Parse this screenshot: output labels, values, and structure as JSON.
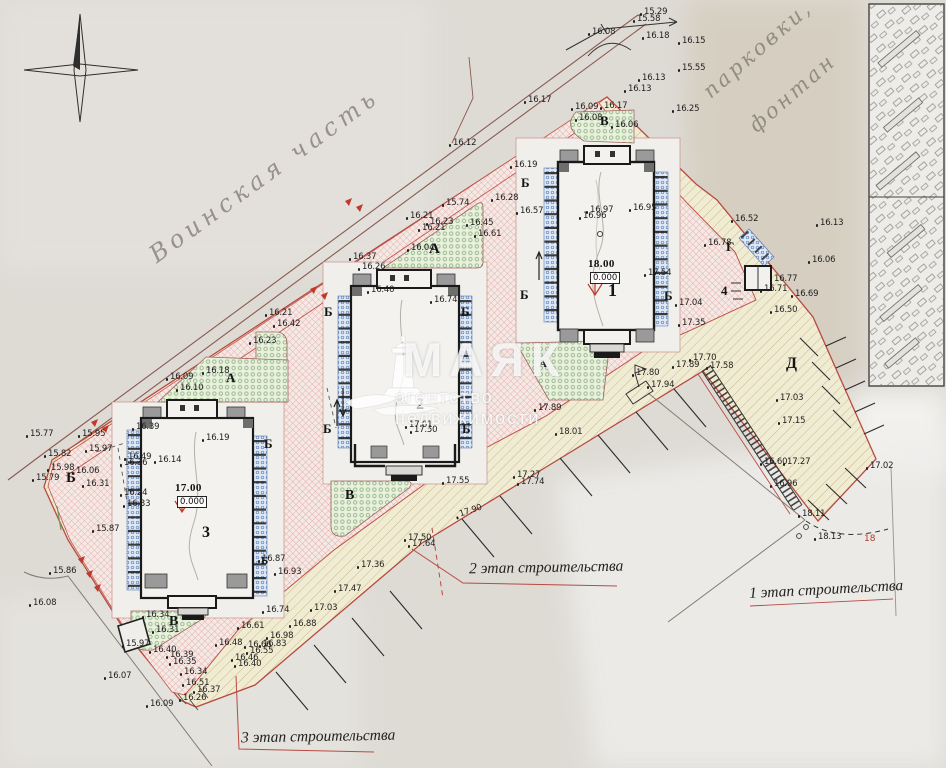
{
  "watermark": {
    "brand": "МАЯК",
    "tagline": "агентство недвижимости"
  },
  "handwriting": {
    "military_area": "Воинская часть",
    "parking": "парковки,",
    "fountain": "фонтан"
  },
  "stages": [
    {
      "label": "1 этап строительства"
    },
    {
      "label": "2 этап строительства"
    },
    {
      "label": "3 этап строительства"
    }
  ],
  "buildings": [
    {
      "number": "1",
      "elevation": "18.00",
      "datum": "0.000"
    },
    {
      "number": "2",
      "marks": [
        "17.01",
        "17.50"
      ]
    },
    {
      "number": "3",
      "elevation": "17.00",
      "datum": "0.000"
    },
    {
      "number": "4"
    }
  ],
  "parking_count": "18",
  "building_labels": [
    {
      "t": "18.00",
      "x": 588,
      "y": 258,
      "s": 11,
      "cls": "blev",
      "name": "building-1-elevation"
    },
    {
      "t": "0.000",
      "x": 590,
      "y": 272,
      "s": 8.5,
      "cls": "bdat",
      "name": "building-1-datum"
    },
    {
      "t": "1",
      "x": 608,
      "y": 281,
      "s": 18,
      "cls": "bnum",
      "name": "building-1-number"
    },
    {
      "t": "2",
      "x": 416,
      "y": 397,
      "s": 16,
      "cls": "bnum",
      "name": "building-2-number"
    },
    {
      "t": "17.00",
      "x": 175,
      "y": 482,
      "s": 11,
      "cls": "blev",
      "name": "building-3-elevation"
    },
    {
      "t": "0.000",
      "x": 177,
      "y": 496,
      "s": 8.5,
      "cls": "bdat",
      "name": "building-3-datum"
    },
    {
      "t": "3",
      "x": 202,
      "y": 525,
      "s": 16,
      "cls": "bnum",
      "name": "building-3-number"
    },
    {
      "t": "4",
      "x": 721,
      "y": 284,
      "s": 13,
      "cls": "bnum",
      "name": "building-4-number"
    },
    {
      "t": "18",
      "x": 864,
      "y": 534,
      "s": 9,
      "cls": "rednum",
      "name": "parking-count"
    }
  ],
  "zone_letters": [
    [
      "В",
      600,
      114,
      13
    ],
    [
      "Б",
      521,
      176,
      13
    ],
    [
      "Б",
      520,
      288,
      13
    ],
    [
      "Б",
      664,
      289,
      13
    ],
    [
      "Г",
      726,
      240,
      13
    ],
    [
      "Д",
      786,
      356,
      16
    ],
    [
      "А",
      429,
      242,
      15
    ],
    [
      "Б",
      324,
      305,
      13
    ],
    [
      "Б",
      461,
      305,
      13
    ],
    [
      "Б",
      323,
      422,
      13
    ],
    [
      "Б",
      462,
      422,
      13
    ],
    [
      "В",
      345,
      489,
      14
    ],
    [
      "А",
      226,
      371,
      13
    ],
    [
      "Б",
      264,
      437,
      13
    ],
    [
      "Б",
      66,
      471,
      15
    ],
    [
      "Б",
      261,
      556,
      11
    ],
    [
      "В",
      169,
      615,
      14
    ],
    [
      "А",
      539,
      359,
      11
    ]
  ],
  "spot_elevations": [
    [
      "15.29",
      644,
      7
    ],
    [
      "15.58",
      637,
      14
    ],
    [
      "16.08",
      592,
      27
    ],
    [
      "16.18",
      646,
      31
    ],
    [
      "16.15",
      682,
      36
    ],
    [
      "15.55",
      682,
      63
    ],
    [
      "16.13",
      642,
      73
    ],
    [
      "16.13",
      628,
      84
    ],
    [
      "16.25",
      676,
      104
    ],
    [
      "16.09",
      575,
      102
    ],
    [
      "16.17",
      604,
      101
    ],
    [
      "16.08",
      579,
      113
    ],
    [
      "16.06",
      615,
      120
    ],
    [
      "16.17",
      528,
      95
    ],
    [
      "16.12",
      453,
      138
    ],
    [
      "16.19",
      514,
      160
    ],
    [
      "16.28",
      495,
      193
    ],
    [
      "16.57",
      520,
      206
    ],
    [
      "16.97",
      590,
      205
    ],
    [
      "16.96",
      583,
      211
    ],
    [
      "16.95",
      633,
      203
    ],
    [
      "17.54",
      648,
      268
    ],
    [
      "17.04",
      679,
      298
    ],
    [
      "17.35",
      682,
      318
    ],
    [
      "16.52",
      735,
      214
    ],
    [
      "16.78",
      708,
      238
    ],
    [
      "16.77",
      774,
      274
    ],
    [
      "16.71",
      764,
      284
    ],
    [
      "16.69",
      795,
      289
    ],
    [
      "16.50",
      774,
      305
    ],
    [
      "16.13",
      820,
      218
    ],
    [
      "16.06",
      812,
      255
    ],
    [
      "17.70",
      693,
      353
    ],
    [
      "17.89",
      676,
      360
    ],
    [
      "17.58",
      710,
      361
    ],
    [
      "17.80",
      636,
      368
    ],
    [
      "17.94",
      651,
      380
    ],
    [
      "17.03",
      780,
      393
    ],
    [
      "17.15",
      782,
      416
    ],
    [
      "16.60",
      764,
      457
    ],
    [
      "17.27",
      787,
      457
    ],
    [
      "16.96",
      774,
      479
    ],
    [
      "17.02",
      870,
      461
    ],
    [
      "18.11",
      802,
      509
    ],
    [
      "18.13",
      818,
      532
    ],
    [
      "18.01",
      559,
      427
    ],
    [
      "17.89",
      538,
      403
    ],
    [
      "15.74",
      446,
      198
    ],
    [
      "16.21",
      410,
      211
    ],
    [
      "16.23",
      430,
      217
    ],
    [
      "16.21",
      422,
      223
    ],
    [
      "16.45",
      470,
      218
    ],
    [
      "16.61",
      478,
      229
    ],
    [
      "16.04",
      411,
      243
    ],
    [
      "16.37",
      353,
      252
    ],
    [
      "16.26",
      362,
      262
    ],
    [
      "16.40",
      371,
      285
    ],
    [
      "16.74",
      434,
      295
    ],
    [
      "16.21",
      269,
      308
    ],
    [
      "16.42",
      277,
      319
    ],
    [
      "16.23",
      253,
      336
    ],
    [
      "17.01",
      409,
      420
    ],
    [
      "17.50",
      414,
      425
    ],
    [
      "17.55",
      446,
      476
    ],
    [
      "17.27",
      517,
      470
    ],
    [
      "17.74",
      521,
      477
    ],
    [
      "17.90",
      459,
      506,
      -18
    ],
    [
      "17.50",
      408,
      533
    ],
    [
      "17.64",
      412,
      539
    ],
    [
      "17.36",
      361,
      560
    ],
    [
      "17.47",
      338,
      584
    ],
    [
      "17.03",
      314,
      603
    ],
    [
      "16.74",
      266,
      605
    ],
    [
      "16.98",
      270,
      631
    ],
    [
      "16.61",
      241,
      621
    ],
    [
      "16.88",
      293,
      619
    ],
    [
      "16.48",
      219,
      638
    ],
    [
      "16.66",
      248,
      640
    ],
    [
      "16.83",
      263,
      639
    ],
    [
      "16.55",
      250,
      646
    ],
    [
      "16.46",
      235,
      653
    ],
    [
      "16.40",
      238,
      659
    ],
    [
      "16.34",
      184,
      667
    ],
    [
      "16.51",
      186,
      678
    ],
    [
      "16.37",
      197,
      685
    ],
    [
      "16.26",
      183,
      693
    ],
    [
      "16.09",
      150,
      699
    ],
    [
      "16.07",
      108,
      671
    ],
    [
      "15.86",
      53,
      566
    ],
    [
      "16.08",
      33,
      598
    ],
    [
      "15.97",
      126,
      639
    ],
    [
      "16.40",
      153,
      645
    ],
    [
      "16.39",
      170,
      650
    ],
    [
      "16.35",
      173,
      657
    ],
    [
      "16.34",
      146,
      610
    ],
    [
      "16.31",
      156,
      625
    ],
    [
      "16.87",
      262,
      554
    ],
    [
      "16.93",
      278,
      567
    ],
    [
      "16.19",
      206,
      433
    ],
    [
      "16.39",
      136,
      422
    ],
    [
      "16.14",
      158,
      455
    ],
    [
      "16.49",
      128,
      452
    ],
    [
      "16.36",
      124,
      458
    ],
    [
      "16.24",
      124,
      488
    ],
    [
      "16.33",
      127,
      499
    ],
    [
      "15.95",
      82,
      429
    ],
    [
      "15.97",
      89,
      444
    ],
    [
      "15.82",
      48,
      449
    ],
    [
      "15.77",
      30,
      429
    ],
    [
      "15.98",
      51,
      463
    ],
    [
      "16.06",
      76,
      466
    ],
    [
      "15.79",
      36,
      473
    ],
    [
      "16.31",
      86,
      479
    ],
    [
      "15.87",
      96,
      524
    ],
    [
      "16.09",
      170,
      372
    ],
    [
      "16.18",
      206,
      366
    ],
    [
      "16.10",
      180,
      383
    ]
  ]
}
